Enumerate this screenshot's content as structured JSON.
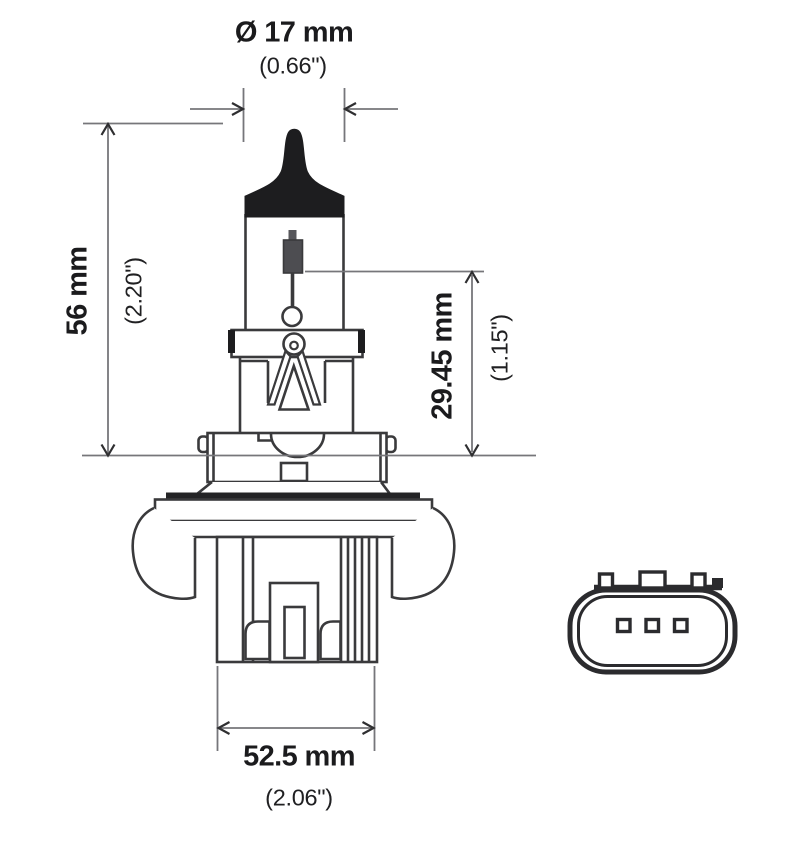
{
  "drawing": {
    "description": "Technical dimension drawing of an H13 halogen headlight bulb with base connector face view",
    "labels": {
      "diameter_mm": "Ø 17 mm",
      "diameter_in": "(0.66\")",
      "height_mm": "56 mm",
      "height_in": "(2.20\")",
      "filament_mm": "29.45 mm",
      "filament_in": "(1.15\")",
      "width_mm": "52.5 mm",
      "width_in": "(2.06\")"
    },
    "connector": {
      "pin_count": 3
    },
    "colors": {
      "outline": "#3a3a3c",
      "dimension_line": "#76767a",
      "arrowhead": "#2f2f31",
      "black_fill": "#1d1d1f",
      "text": "#1b1b1d",
      "background": "#ffffff"
    }
  }
}
